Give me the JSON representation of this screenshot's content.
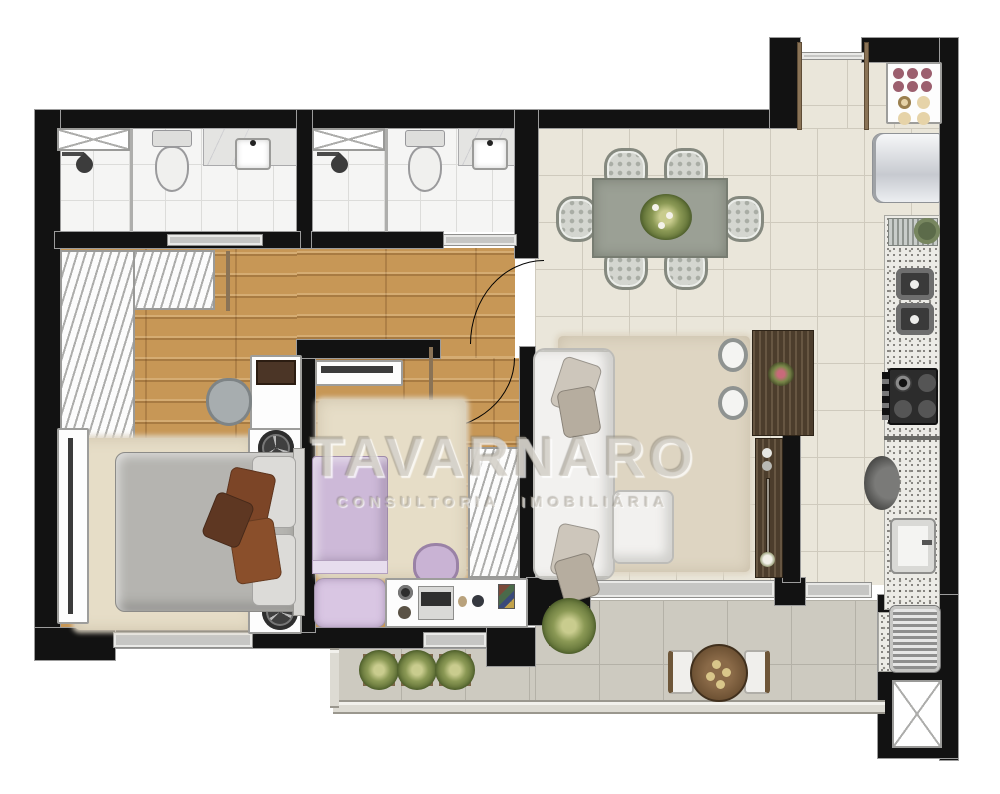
{
  "document": {
    "type": "apartment-floor-plan",
    "style": "furnished top-down render"
  },
  "watermark": {
    "line1": "TAVARNARO",
    "line2": "CONSULTORIA IMOBILIÁRIA"
  },
  "colors": {
    "wall": "#121212",
    "wood": "#c79756",
    "tile": "#eae6da",
    "balcony": "#cdcac0",
    "rug": "#e6ddc7",
    "darkwood": "#4c3d2c",
    "bedGray": "#b5b4b0",
    "lavender": "#cdb9d8",
    "pillowBrown": "#7c4527",
    "sofa": "#f2f1ef",
    "glassGray": "#c6c6c4",
    "plantGreen": "#6d7d3e",
    "graniteBase": "#ecebe6"
  },
  "rooms": {
    "list": [
      "bathroom-1",
      "bathroom-2",
      "hall",
      "master-bedroom",
      "bedroom-2",
      "dining-room",
      "living-room",
      "kitchen",
      "laundry",
      "balcony",
      "entry"
    ]
  },
  "furniture": {
    "bathroom_1": [
      "shower-box",
      "shower-head",
      "toilet",
      "vanity-counter",
      "sink"
    ],
    "bathroom_2": [
      "shower-box",
      "shower-head",
      "toilet",
      "vanity-counter",
      "sink"
    ],
    "master_bedroom": [
      "l-shaped-wardrobe",
      "double-bed",
      "nightstand-fan",
      "nightstand-fan",
      "dresser-tv",
      "chair",
      "rug",
      "tv-panel",
      "window"
    ],
    "bedroom_2": [
      "single-bed",
      "desk-with-laptop",
      "desk-chair",
      "wardrobe",
      "shelf",
      "rug",
      "window"
    ],
    "dining_room": [
      "dining-table",
      "six-chairs",
      "centerpiece-plant"
    ],
    "living_room": [
      "l-shaped-sofa",
      "throw-pillows",
      "rug",
      "bar-counter",
      "two-stools",
      "sideboard",
      "sliding-door"
    ],
    "kitchen": [
      "dish-cabinet",
      "refrigerator",
      "counter-dish-rack",
      "double-sink",
      "cooktop-4-burners",
      "laundry-sink"
    ],
    "laundry": [
      "washing-machine",
      "duct-shaft"
    ],
    "balcony": [
      "three-potted-plants",
      "large-potted-plant",
      "round-table",
      "two-chairs",
      "railing"
    ]
  }
}
